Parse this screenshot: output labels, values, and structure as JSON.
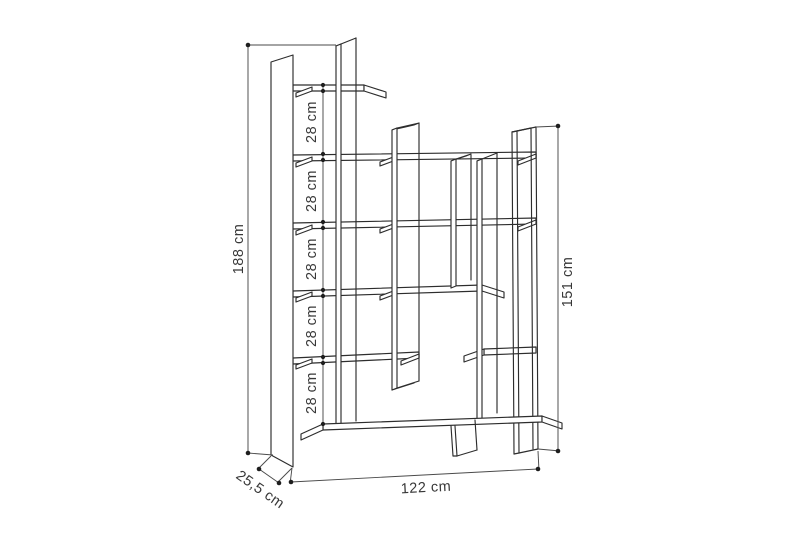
{
  "figure": {
    "type": "furniture dimension diagram",
    "subject": "asymmetric bookcase shelving unit technical line drawing",
    "background_color": "#ffffff",
    "line_color": "#2d2d2d",
    "unit": "cm"
  },
  "dimensions": {
    "total_height": {
      "label": "188 cm",
      "value": 188
    },
    "right_section_height": {
      "label": "151 cm",
      "value": 151
    },
    "total_width": {
      "label": "122 cm",
      "value": 122
    },
    "depth": {
      "label": "25,5 cm",
      "value": 25.5
    },
    "shelf_spacings": [
      {
        "label": "28 cm",
        "value": 28
      },
      {
        "label": "28 cm",
        "value": 28
      },
      {
        "label": "28 cm",
        "value": 28
      },
      {
        "label": "28 cm",
        "value": 28
      },
      {
        "label": "28 cm",
        "value": 28
      }
    ]
  }
}
